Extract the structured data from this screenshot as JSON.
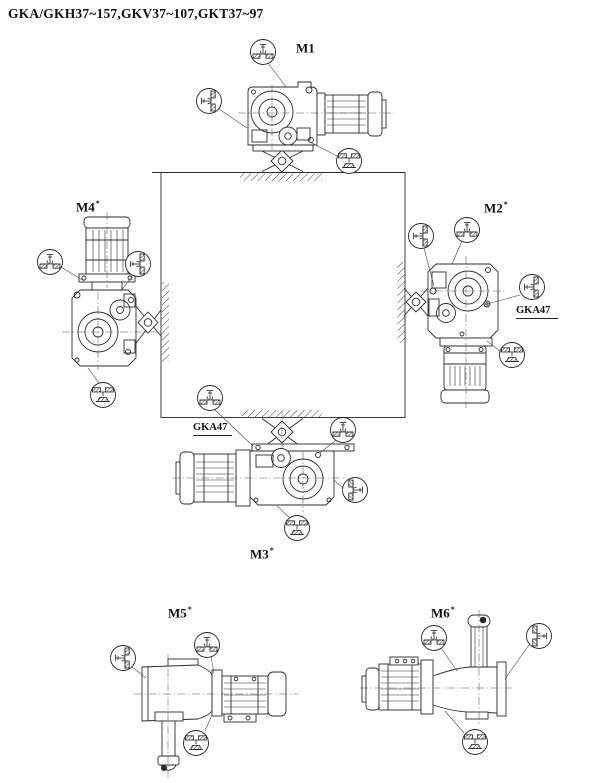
{
  "title": "GKA/GKH37~157,GKV37~107,GKT37~97",
  "labels": {
    "m1": {
      "text": "M1",
      "sup": ""
    },
    "m2": {
      "text": "M2",
      "sup": "*"
    },
    "m3": {
      "text": "M3",
      "sup": "*"
    },
    "m4": {
      "text": "M4",
      "sup": "*"
    },
    "m5": {
      "text": "M5",
      "sup": "*"
    },
    "m6": {
      "text": "M6",
      "sup": "*"
    }
  },
  "annotations": {
    "gka47_m2": "GKA47",
    "gka47_m3": "GKA47"
  },
  "icons": {
    "vent_top": "breather-plug-top-position-icon",
    "plug_side": "oil-level-plug-side-position-icon",
    "drain_bottom": "oil-drain-plug-bottom-position-icon"
  },
  "colors": {
    "line": "#2b2b2b",
    "background": "#ffffff"
  }
}
